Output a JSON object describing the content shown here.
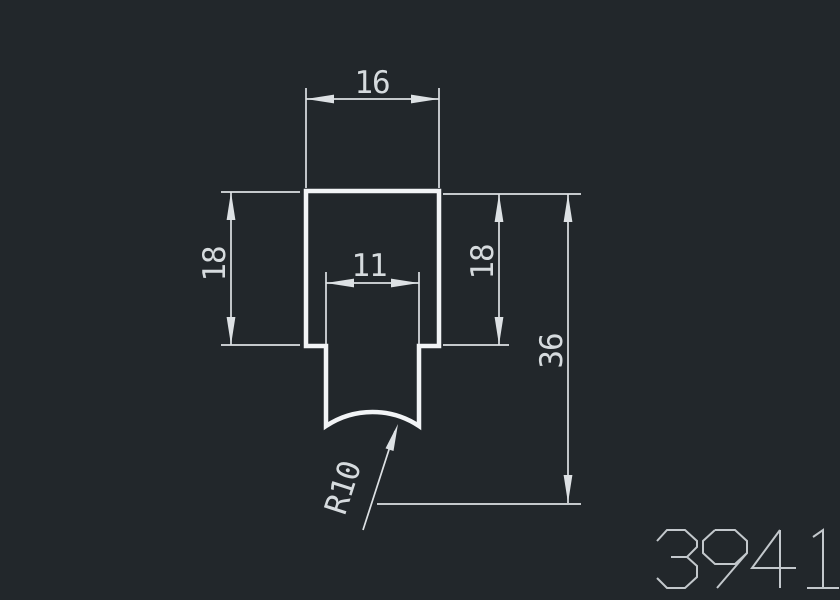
{
  "drawing": {
    "type": "cad-profile-cross-section",
    "part_number": "3941",
    "dimensions": {
      "top_width": "16",
      "left_height": "18",
      "slot_width": "11",
      "right_height": "18",
      "total_height": "36",
      "bottom_radius": "R10"
    }
  },
  "colors": {
    "background": "#22272b",
    "outline": "#f2f4f6",
    "dimension": "#dde1e4",
    "label": "#d6dbde",
    "part_number": "#c3c8cc"
  }
}
